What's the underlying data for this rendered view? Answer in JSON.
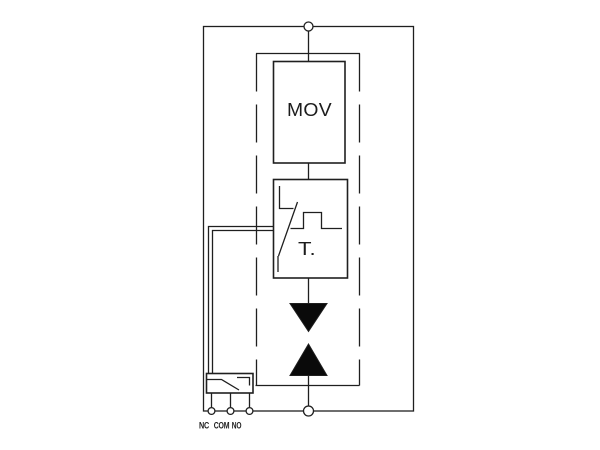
{
  "diagram": {
    "labels": {
      "mov": "MOV",
      "thermal": "T.",
      "terminal_nc": "NC",
      "terminal_com": "COM",
      "terminal_no": "NO"
    },
    "colors": {
      "line": "#1f1f1f",
      "symbol_fill": "#0a0a0a",
      "background": "#ffffff"
    }
  }
}
